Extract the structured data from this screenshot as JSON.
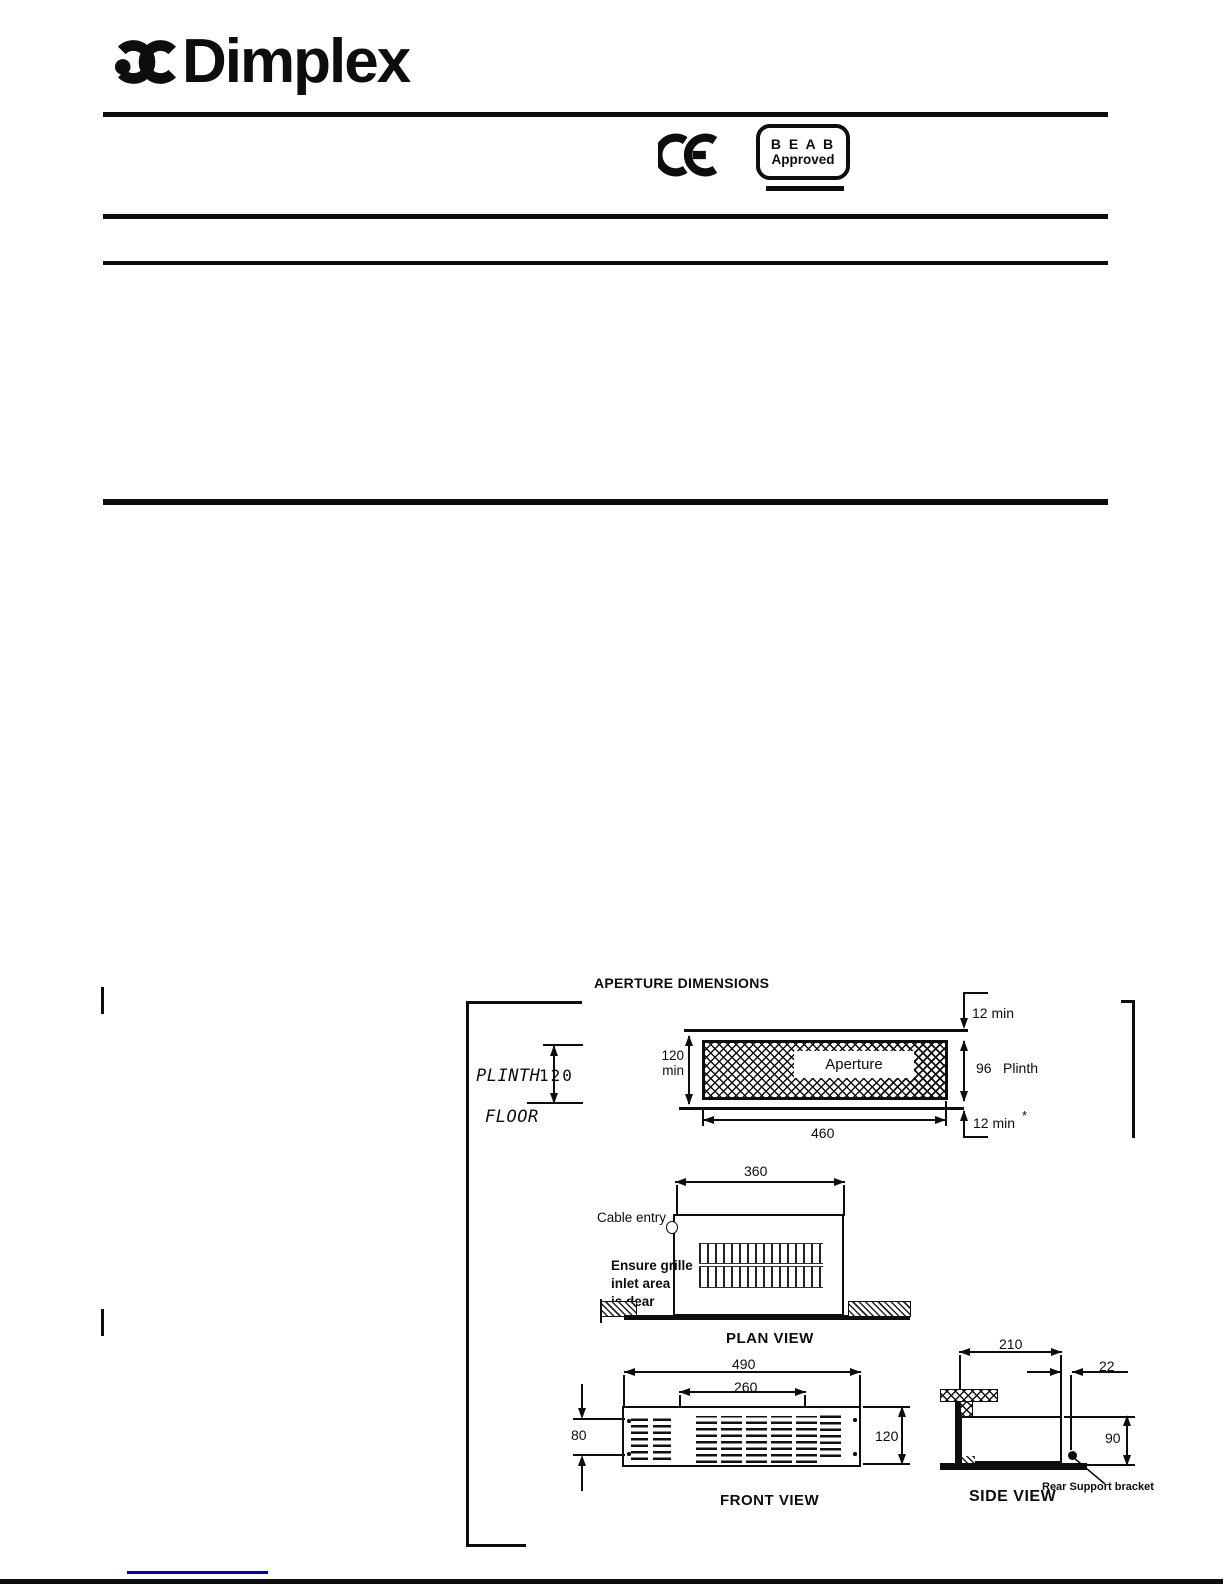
{
  "header": {
    "brand": "Dimplex",
    "beab_line1": "B E A B",
    "beab_line2": "Approved"
  },
  "diagram": {
    "title": "APERTURE DIMENSIONS",
    "plinth_sketch": {
      "plinth": "PLINTH",
      "height": "120",
      "floor": "FLOOR"
    },
    "aperture": {
      "top_clearance": "12 min",
      "height": "120",
      "height_unit": "min",
      "label": "Aperture",
      "plinth_depth": "96",
      "plinth_word": "Plinth",
      "width": "460",
      "bottom_clearance": "12 min",
      "footnote_mark": "*"
    },
    "plan": {
      "width": "360",
      "cable_entry": "Cable entry",
      "note_line1": "Ensure grille",
      "note_line2": "inlet area",
      "note_line3": "is dear",
      "label": "PLAN VIEW"
    },
    "front": {
      "overall_width": "490",
      "element_width": "260",
      "grille_height": "80",
      "height": "120",
      "label": "FRONT VIEW"
    },
    "side": {
      "depth": "210",
      "offset": "22",
      "height": "90",
      "bracket_label": "Rear Support bracket",
      "label": "SIDE VIEW"
    }
  }
}
